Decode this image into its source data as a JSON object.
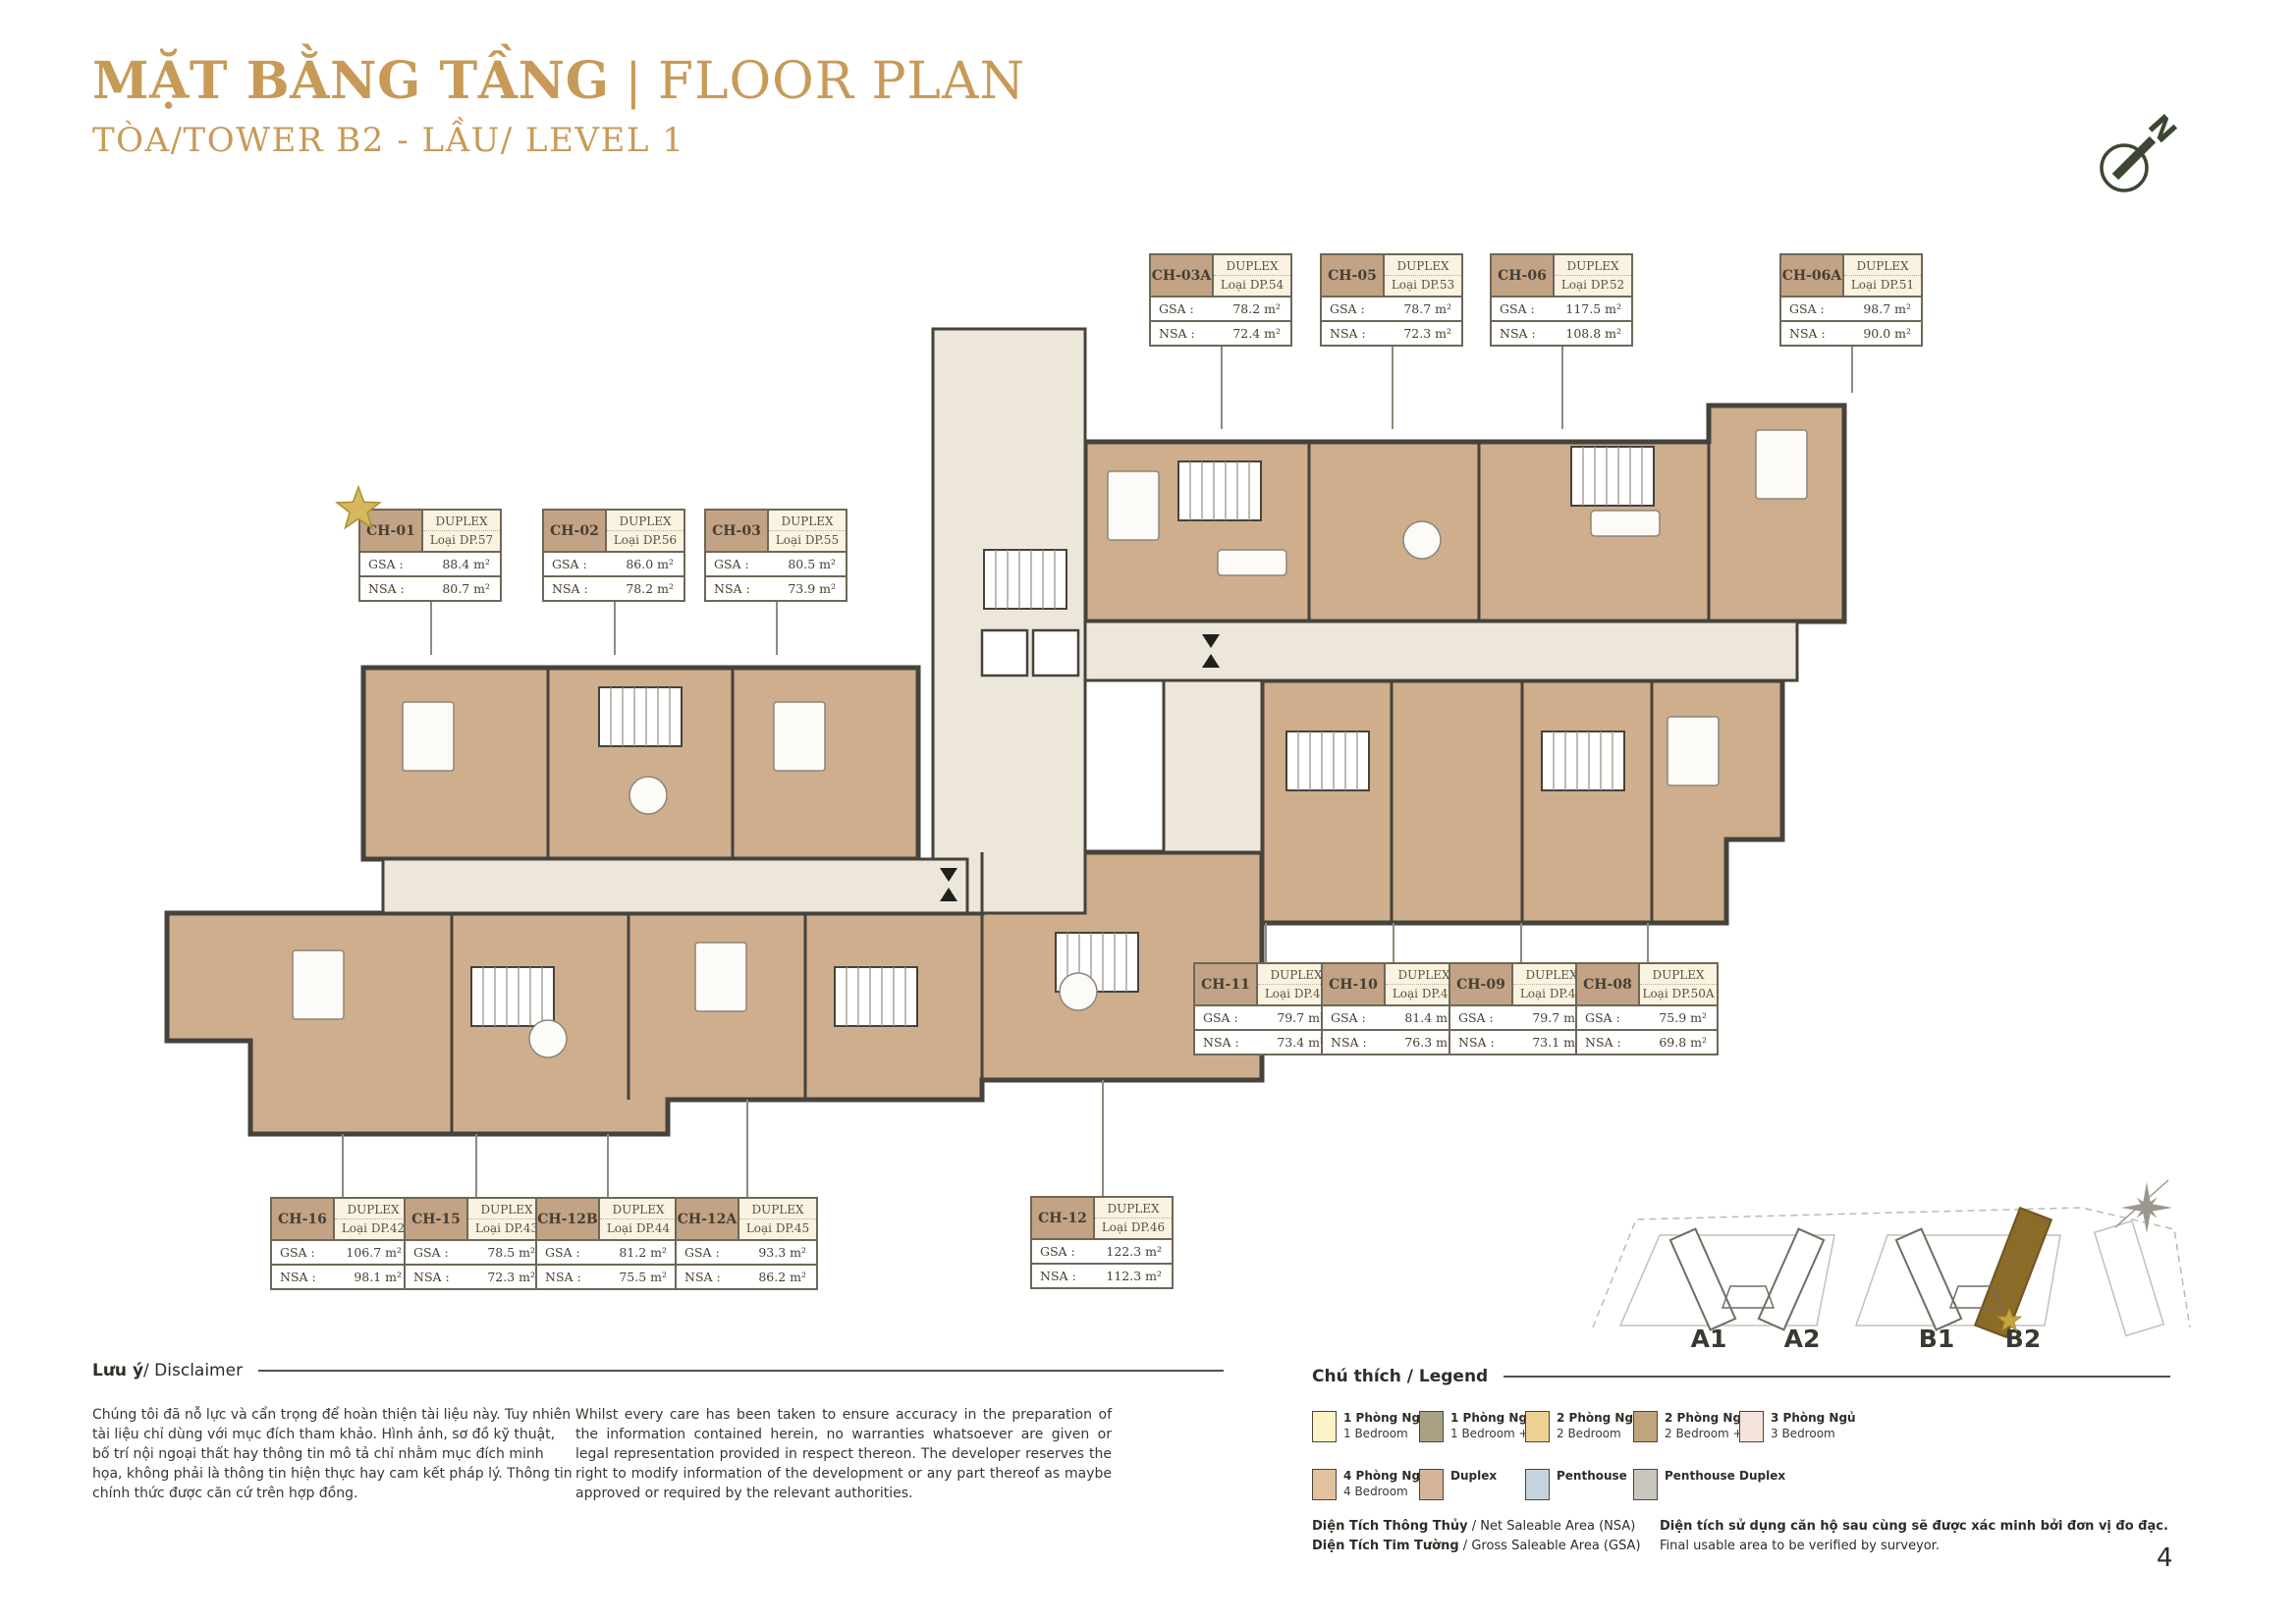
{
  "page": {
    "title_vi": "MẶT BẰNG TẦNG",
    "title_sep": "|",
    "title_en": "FLOOR PLAN",
    "subtitle": "TÒA/TOWER B2 - LẦU/ LEVEL 1",
    "page_number": "4",
    "compass_label": "N"
  },
  "unit_card_labels": {
    "gsa": "GSA :",
    "nsa": "NSA :"
  },
  "units": [
    {
      "id": "CH-03A",
      "type": "DUPLEX",
      "loai": "Loại DP.54",
      "gsa": "78.2 m²",
      "nsa": "72.4 m²",
      "starred": false
    },
    {
      "id": "CH-05",
      "type": "DUPLEX",
      "loai": "Loại DP.53",
      "gsa": "78.7 m²",
      "nsa": "72.3 m²",
      "starred": false
    },
    {
      "id": "CH-06",
      "type": "DUPLEX",
      "loai": "Loại DP.52",
      "gsa": "117.5 m²",
      "nsa": "108.8 m²",
      "starred": false
    },
    {
      "id": "CH-06A",
      "type": "DUPLEX",
      "loai": "Loại DP.51",
      "gsa": "98.7 m²",
      "nsa": "90.0 m²",
      "starred": false
    },
    {
      "id": "CH-01",
      "type": "DUPLEX",
      "loai": "Loại DP.57",
      "gsa": "88.4 m²",
      "nsa": "80.7 m²",
      "starred": true
    },
    {
      "id": "CH-02",
      "type": "DUPLEX",
      "loai": "Loại DP.56",
      "gsa": "86.0 m²",
      "nsa": "78.2 m²",
      "starred": false
    },
    {
      "id": "CH-03",
      "type": "DUPLEX",
      "loai": "Loại DP.55",
      "gsa": "80.5 m²",
      "nsa": "73.9 m²",
      "starred": false
    },
    {
      "id": "CH-11",
      "type": "DUPLEX",
      "loai": "Loại DP.47",
      "gsa": "79.7 m²",
      "nsa": "73.4 m²",
      "starred": false
    },
    {
      "id": "CH-10",
      "type": "DUPLEX",
      "loai": "Loại DP.48",
      "gsa": "81.4 m²",
      "nsa": "76.3 m²",
      "starred": false
    },
    {
      "id": "CH-09",
      "type": "DUPLEX",
      "loai": "Loại DP.49",
      "gsa": "79.7 m²",
      "nsa": "73.1 m²",
      "starred": false
    },
    {
      "id": "CH-08",
      "type": "DUPLEX",
      "loai": "Loại DP.50A",
      "gsa": "75.9 m²",
      "nsa": "69.8 m²",
      "starred": false
    },
    {
      "id": "CH-16",
      "type": "DUPLEX",
      "loai": "Loại DP.42",
      "gsa": "106.7 m²",
      "nsa": "98.1 m²",
      "starred": false
    },
    {
      "id": "CH-15",
      "type": "DUPLEX",
      "loai": "Loại DP.43",
      "gsa": "78.5 m²",
      "nsa": "72.3 m²",
      "starred": false
    },
    {
      "id": "CH-12B",
      "type": "DUPLEX",
      "loai": "Loại DP.44",
      "gsa": "81.2 m²",
      "nsa": "75.5 m²",
      "starred": false
    },
    {
      "id": "CH-12A",
      "type": "DUPLEX",
      "loai": "Loại DP.45",
      "gsa": "93.3 m²",
      "nsa": "86.2 m²",
      "starred": false
    },
    {
      "id": "CH-12",
      "type": "DUPLEX",
      "loai": "Loại DP.46",
      "gsa": "122.3 m²",
      "nsa": "112.3 m²",
      "starred": false
    }
  ],
  "disclaimer": {
    "heading_vi": "Lưu ý",
    "heading_rest": " / Disclaimer",
    "text_vi": "Chúng tôi đã nỗ lực và cẩn trọng để hoàn thiện tài liệu này. Tuy nhiên tài liệu chỉ dùng với mục đích tham khảo. Hình ảnh, sơ đồ kỹ thuật, bố trí nội ngoại thất hay thông tin mô tả chỉ nhằm mục đích minh họa, không phải là thông tin hiện thực hay cam kết pháp lý. Thông tin chính thức được căn cứ trên hợp đồng.",
    "text_en": "Whilst every care has been taken to ensure accuracy in the preparation of the information contained herein, no warranties whatsoever are given or legal representation provided in respect thereon. The developer reserves the right to modify information of the development or any part thereof as maybe approved or required by the relevant authorities."
  },
  "legend": {
    "heading": "Chú thích / Legend",
    "items": [
      {
        "vi": "1 Phòng Ngủ",
        "en": "1 Bedroom",
        "color": "#fdf3c4"
      },
      {
        "vi": "1 Phòng Ngủ +",
        "en": "1 Bedroom +",
        "color": "#a9a184"
      },
      {
        "vi": "2 Phòng Ngủ",
        "en": "2 Bedroom",
        "color": "#ecd193"
      },
      {
        "vi": "2 Phòng Ngủ +",
        "en": "2 Bedroom +",
        "color": "#c0a47b"
      },
      {
        "vi": "3 Phòng Ngủ",
        "en": "3 Bedroom",
        "color": "#f5e3dc"
      },
      {
        "vi": "4 Phòng Ngủ",
        "en": "4 Bedroom",
        "color": "#e2c19e"
      },
      {
        "vi": "Duplex",
        "en": "",
        "color": "#d4b496"
      },
      {
        "vi": "Penthouse",
        "en": "",
        "color": "#c4d3dd"
      },
      {
        "vi": "Penthouse Duplex",
        "en": "",
        "color": "#c9c6bd"
      }
    ],
    "notes_left": [
      {
        "bold": "Diện Tích Thông Thủy",
        "rest": " / Net Saleable Area (NSA)"
      },
      {
        "bold": "Diện Tích Tim Tường",
        "rest": " / Gross Saleable Area (GSA)"
      }
    ],
    "notes_right": [
      {
        "text": "Diện tích sử dụng căn hộ sau cùng sẽ được xác minh bởi đơn vị đo đạc."
      },
      {
        "text": "Final usable area to be verified by surveyor."
      }
    ]
  },
  "key_plan": {
    "towers": [
      {
        "id": "A1",
        "highlighted": false
      },
      {
        "id": "A2",
        "highlighted": false
      },
      {
        "id": "B1",
        "highlighted": false
      },
      {
        "id": "B2",
        "highlighted": true
      }
    ]
  },
  "colors": {
    "title_gold": "#c89a58",
    "unit_fill": "#cfae8d",
    "corridor_fill": "#ece6db",
    "wall": "#46423c",
    "card_id_bg": "#c3a385",
    "card_type_bg": "#fbf3e2",
    "highlight_tower": "#8a6b28",
    "compass_green": "#3b4734",
    "star_gold": "#d4b75f"
  }
}
